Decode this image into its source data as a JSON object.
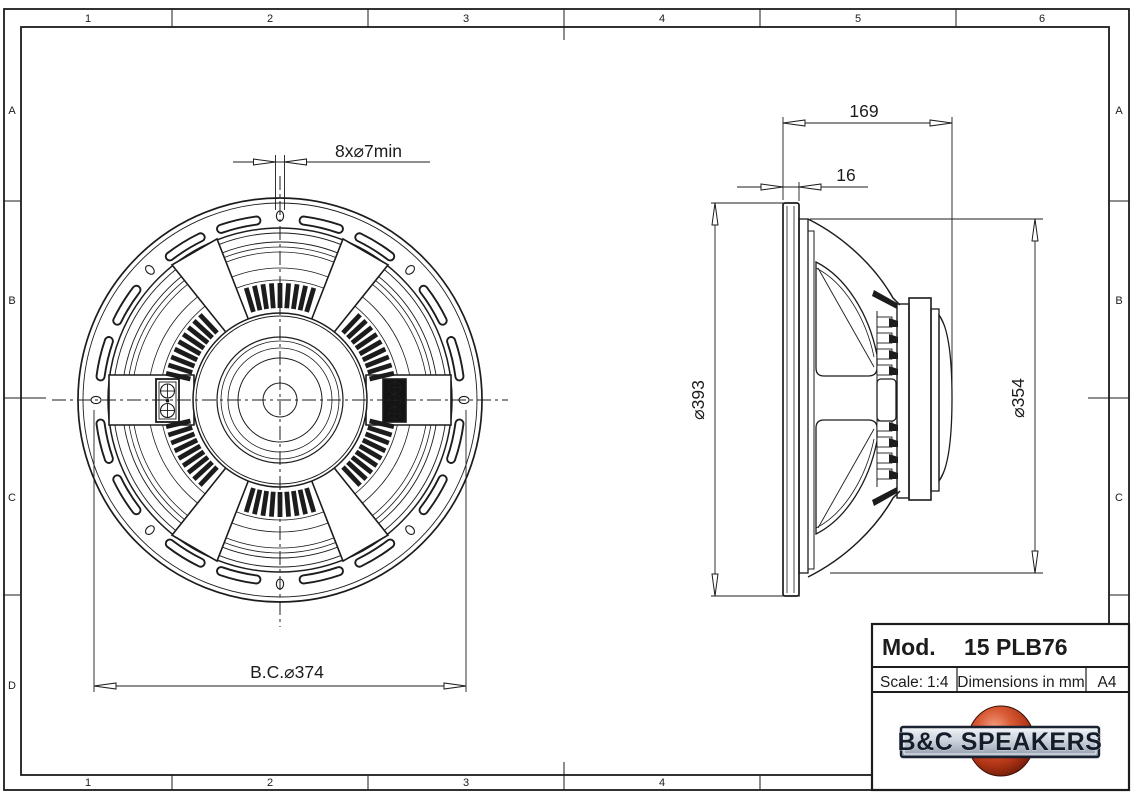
{
  "frame": {
    "top_labels": [
      "1",
      "2",
      "3",
      "4",
      "5",
      "6"
    ],
    "bottom_labels": [
      "1",
      "2",
      "3",
      "4"
    ],
    "left_labels": [
      "A",
      "B",
      "C",
      "D"
    ],
    "right_labels": [
      "A",
      "B",
      "C"
    ]
  },
  "front_view": {
    "dim_holes": "8x⌀7min",
    "dim_bolt_circle": "B.C.⌀374"
  },
  "side_view": {
    "dim_depth": "169",
    "dim_flange": "16",
    "dim_outer_diameter": "⌀393",
    "dim_baffle_diameter": "⌀354"
  },
  "title_block": {
    "mod_label": "Mod.",
    "model": "15 PLB76",
    "scale_label": "Scale:",
    "scale_value": "1:4",
    "dimensions_note": "Dimensions in mm",
    "paper_size": "A4",
    "logo_text": "B&C SPEAKERS"
  },
  "colors": {
    "line": "#1c1c1c",
    "logo_sphere": "#c84423",
    "logo_banner_light": "#f2f4f7",
    "logo_banner_dark": "#8d99a9",
    "logo_text": "#151c2a"
  }
}
